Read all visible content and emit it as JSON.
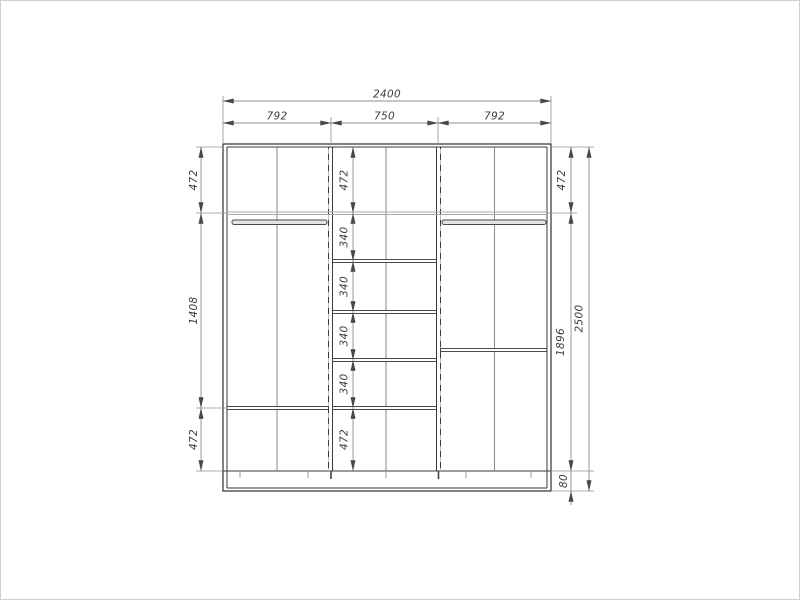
{
  "dims": {
    "top_total": "2400",
    "top_sections": [
      "792",
      "750",
      "792"
    ],
    "left_column": [
      "472",
      "1408",
      "472"
    ],
    "middle_column": [
      "472",
      "340",
      "340",
      "340",
      "340",
      "472"
    ],
    "right_column": [
      "472",
      "1896",
      "80"
    ],
    "overall_height": "2500"
  }
}
